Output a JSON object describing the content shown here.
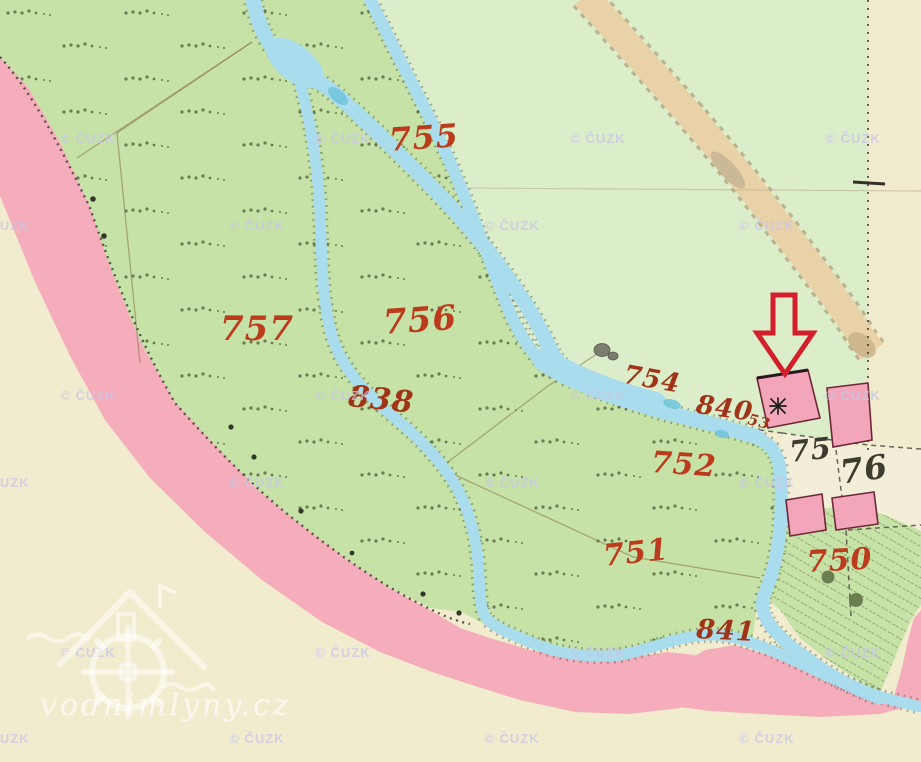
{
  "attribution": {
    "text": "© ČUZK"
  },
  "site_watermark": {
    "text": "vodnimlyny.cz"
  },
  "labels": {
    "parcels": [
      {
        "text": "755"
      },
      {
        "text": "757"
      },
      {
        "text": "756"
      },
      {
        "text": "752"
      },
      {
        "text": "751"
      },
      {
        "text": "750"
      }
    ],
    "waterways": [
      {
        "text": "838"
      },
      {
        "text": "754"
      },
      {
        "text": "840"
      },
      {
        "text": "53"
      },
      {
        "text": "841"
      }
    ],
    "houses": [
      {
        "text": "75"
      },
      {
        "text": "76"
      }
    ]
  },
  "colors": {
    "paper": "#f2ecce",
    "field": "#dcedca",
    "meadow": "#c6e2a7",
    "pink": "#f5adbc",
    "building": "#f3a6ba",
    "building_edge": "#6d2836",
    "courtyard": "#f3eed7",
    "stream": "#a9dcec",
    "stream_deep": "#6fc3dd",
    "bank": "#3c524a",
    "road": "#ead2a8",
    "road_edge": "#9a8760",
    "boundary": "#8c7b52",
    "dots": "#32382b",
    "hatch": "#71824f",
    "tuft": "#41502f",
    "tree_gray": "#7e7e70",
    "tree_dark": "#5c6d42",
    "label_red": "#bb3b1c",
    "label_dark_red": "#a03418",
    "house_black": "#3e3b2f",
    "arrow": "#d21f2a",
    "watermark_color": "#c9c6e6"
  }
}
